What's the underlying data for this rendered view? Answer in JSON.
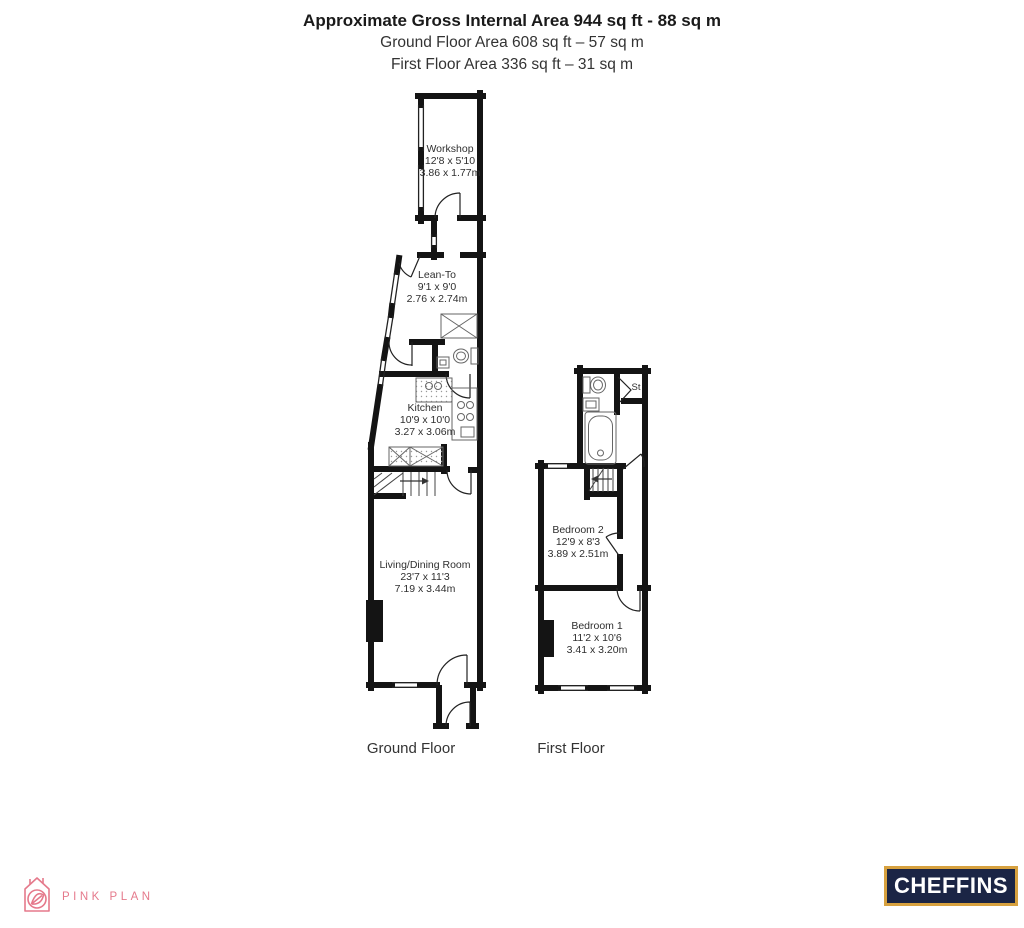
{
  "header": {
    "title": "Approximate Gross Internal Area 944 sq ft - 88 sq m",
    "ground_line": "Ground Floor Area 608 sq ft – 57 sq m",
    "first_line": "First Floor Area 336 sq ft – 31 sq m"
  },
  "ground_floor": {
    "label": "Ground Floor",
    "rooms": {
      "workshop": {
        "name": "Workshop",
        "imperial": "12'8 x 5'10",
        "metric": "3.86 x 1.77m"
      },
      "lean_to": {
        "name": "Lean-To",
        "imperial": "9'1 x 9'0",
        "metric": "2.76 x 2.74m"
      },
      "kitchen": {
        "name": "Kitchen",
        "imperial": "10'9 x 10'0",
        "metric": "3.27 x 3.06m"
      },
      "living_dining": {
        "name": "Living/Dining Room",
        "imperial": "23'7 x 11'3",
        "metric": "7.19 x 3.44m"
      }
    }
  },
  "first_floor": {
    "label": "First Floor",
    "rooms": {
      "bedroom2": {
        "name": "Bedroom 2",
        "imperial": "12'9 x 8'3",
        "metric": "3.89 x 2.51m"
      },
      "bedroom1": {
        "name": "Bedroom 1",
        "imperial": "11'2 x 10'6",
        "metric": "3.41 x 3.20m"
      },
      "store": {
        "name": "St"
      }
    }
  },
  "footer": {
    "pink_plan": "PINK PLAN",
    "cheffins": "CHEFFINS"
  },
  "colors": {
    "wall": "#141414",
    "fixture": "#666666",
    "pink": "#e5798b",
    "cheffins_navy": "#1b2545",
    "cheffins_gold": "#d7a13f"
  }
}
